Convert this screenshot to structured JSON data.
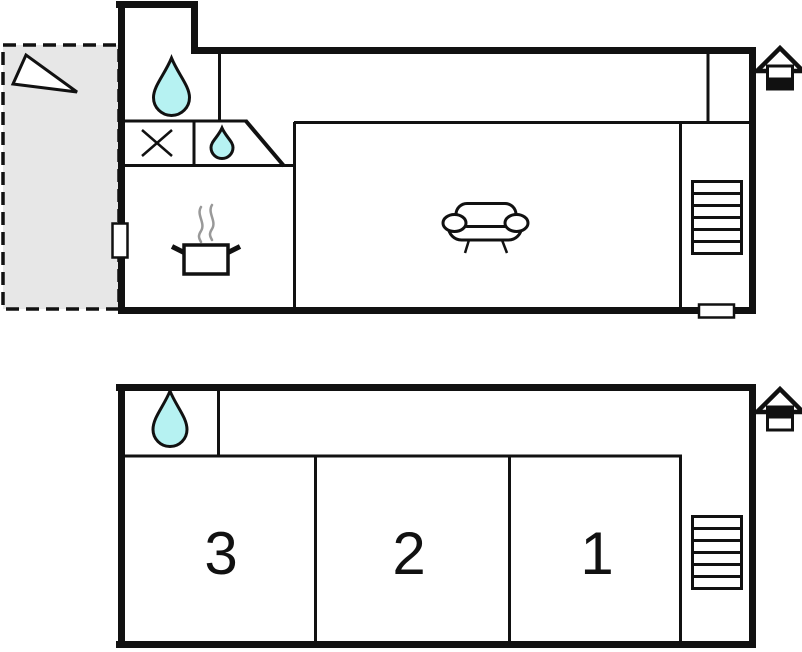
{
  "page": {
    "title": "Holiday home floor plan",
    "type": "floor-plan",
    "floors_count": 2
  },
  "colors": {
    "wall": "#111111",
    "water": "#b6f2f2",
    "terrace": "#e7e7e7",
    "steam": "#999999",
    "paper": "#ffffff"
  },
  "ground_floor": {
    "name": "ground-floor-plan",
    "level_indicator": "lower-level-highlighted",
    "features": [
      "terrace",
      "north-arrow",
      "water-drop",
      "hob-cross",
      "water-drop-small",
      "cooking-pot",
      "steam",
      "sofa",
      "staircase",
      "door-left",
      "door-bottom"
    ]
  },
  "upper_floor": {
    "name": "upper-floor-plan",
    "level_indicator": "upper-level-highlighted",
    "rooms": [
      "3",
      "2",
      "1"
    ],
    "features": [
      "water-drop",
      "staircase"
    ]
  }
}
